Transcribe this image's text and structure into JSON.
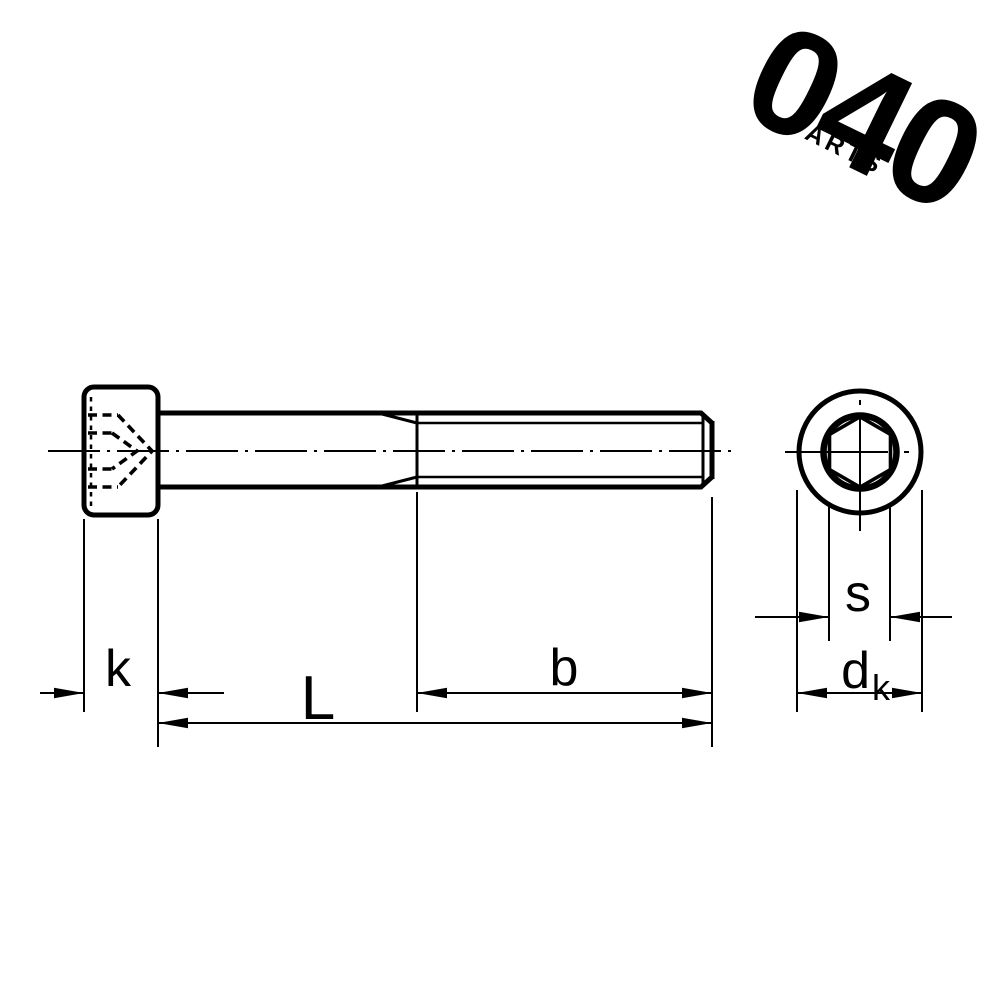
{
  "logo": {
    "digits": "040",
    "subtext": "PARTS"
  },
  "drawing": {
    "type": "technical-drawing-socket-head-cap-screw",
    "views": [
      "side-view",
      "end-view"
    ],
    "dimension_labels": {
      "head_height": "k",
      "total_length": "L",
      "thread_length": "b",
      "socket_width_across_flats": "s",
      "head_diameter_main": "d",
      "head_diameter_sub": "k"
    },
    "colors": {
      "line": "#000000",
      "background": "#ffffff"
    }
  }
}
